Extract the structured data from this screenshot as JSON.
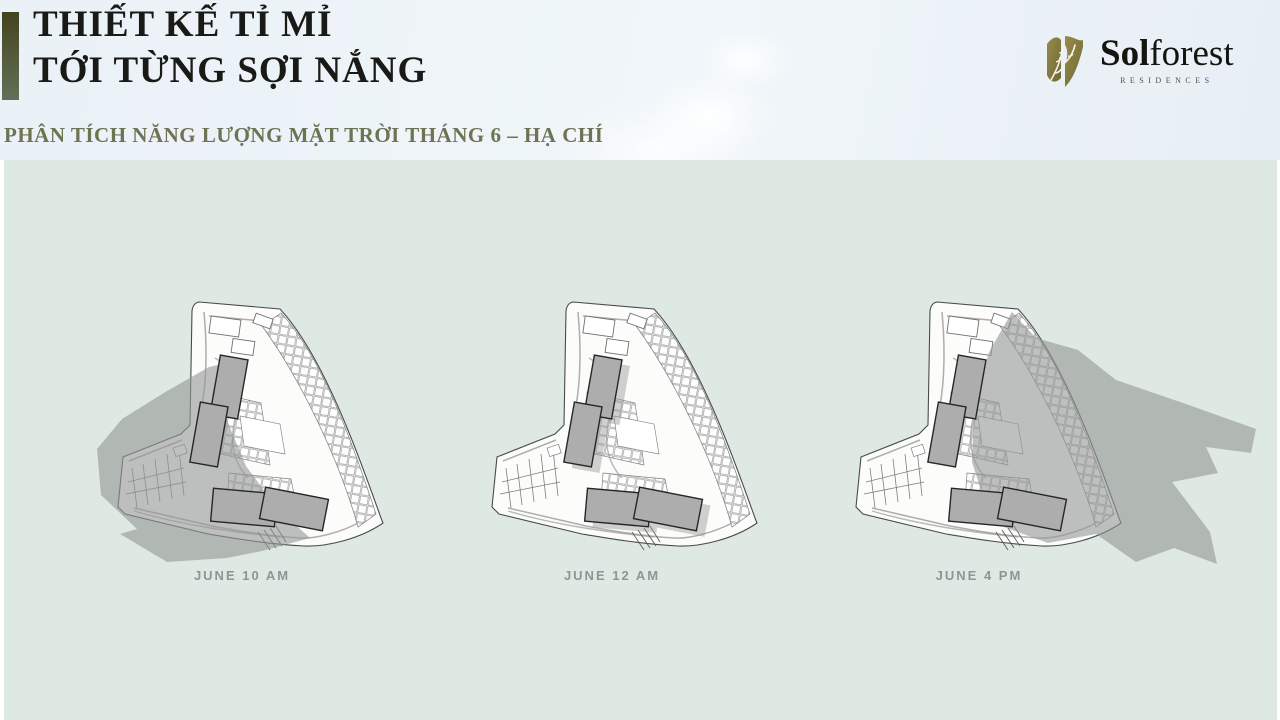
{
  "header": {
    "title_line1": "THIẾT KẾ TỈ MỈ",
    "title_line2": "TỚI TỪNG SỢI NẮNG",
    "subtitle": "PHÂN TÍCH NĂNG LƯỢNG MẶT TRỜI THÁNG 6 – HẠ CHÍ",
    "logo": {
      "name_bold": "Sol",
      "name_regular": "forest",
      "tagline": "RESIDENCES",
      "emblem_icon": "solforest-leaf-emblem-icon"
    }
  },
  "diagrams": [
    {
      "caption": "JUNE 10 AM",
      "shadow_cast": "west"
    },
    {
      "caption": "JUNE 12 AM",
      "shadow_cast": "minimal"
    },
    {
      "caption": "JUNE 4 PM",
      "shadow_cast": "east"
    }
  ],
  "colors": {
    "accent_bar_top": "#45431f",
    "accent_bar_bottom": "#5f7158",
    "title_text": "#191a16",
    "subtitle_text": "#6e7354",
    "panel_background": "#dfe9e3",
    "caption_text": "#8d9597",
    "logo_gold": "#8d8046",
    "building_gray": "#adadad",
    "shadow_gray": "#949a96"
  }
}
